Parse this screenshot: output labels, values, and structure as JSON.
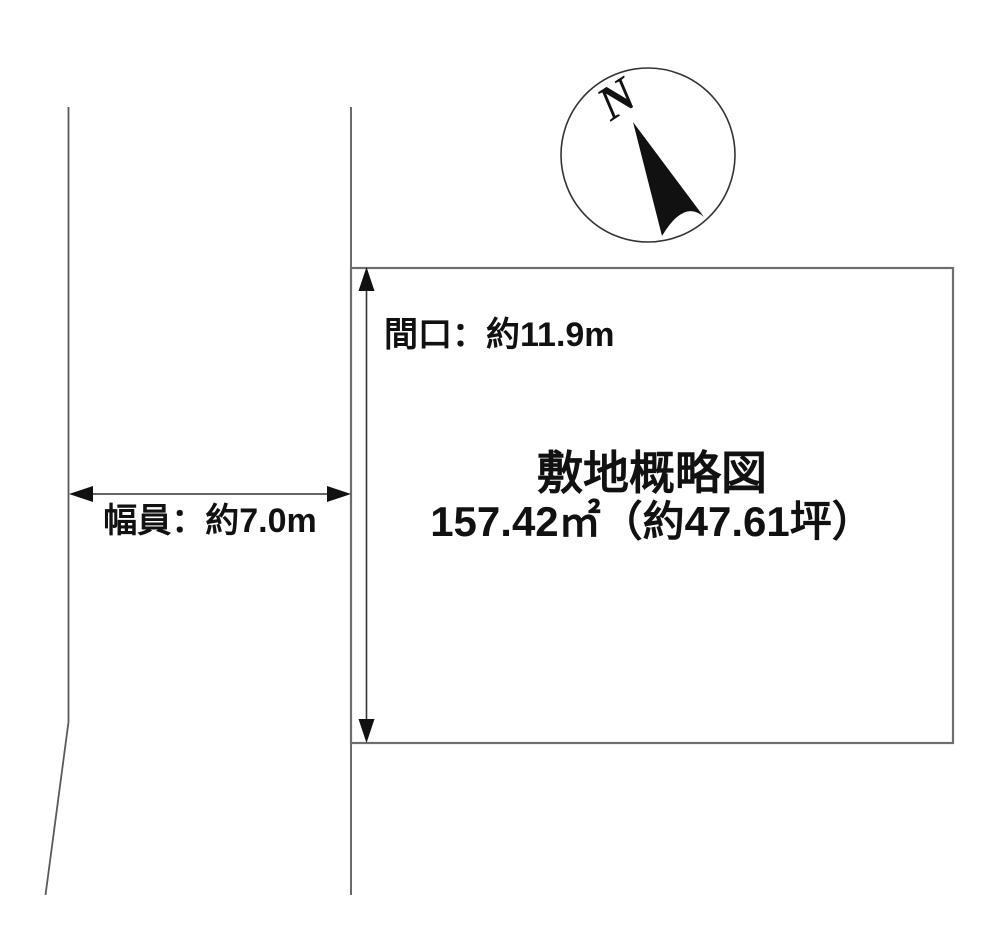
{
  "diagram": {
    "title": "敷地概略図",
    "area_label": "157.42㎡（約47.61坪）",
    "frontage_label": "間口：約11.9m",
    "road_width_label": "幅員：約7.0m",
    "compass": {
      "north_label": "N"
    },
    "colors": {
      "background": "#ffffff",
      "boundary_gray": "#6e6e6e",
      "road_gray": "#5a5a5a",
      "dimension_line": "#333333",
      "ink": "#111111"
    }
  }
}
